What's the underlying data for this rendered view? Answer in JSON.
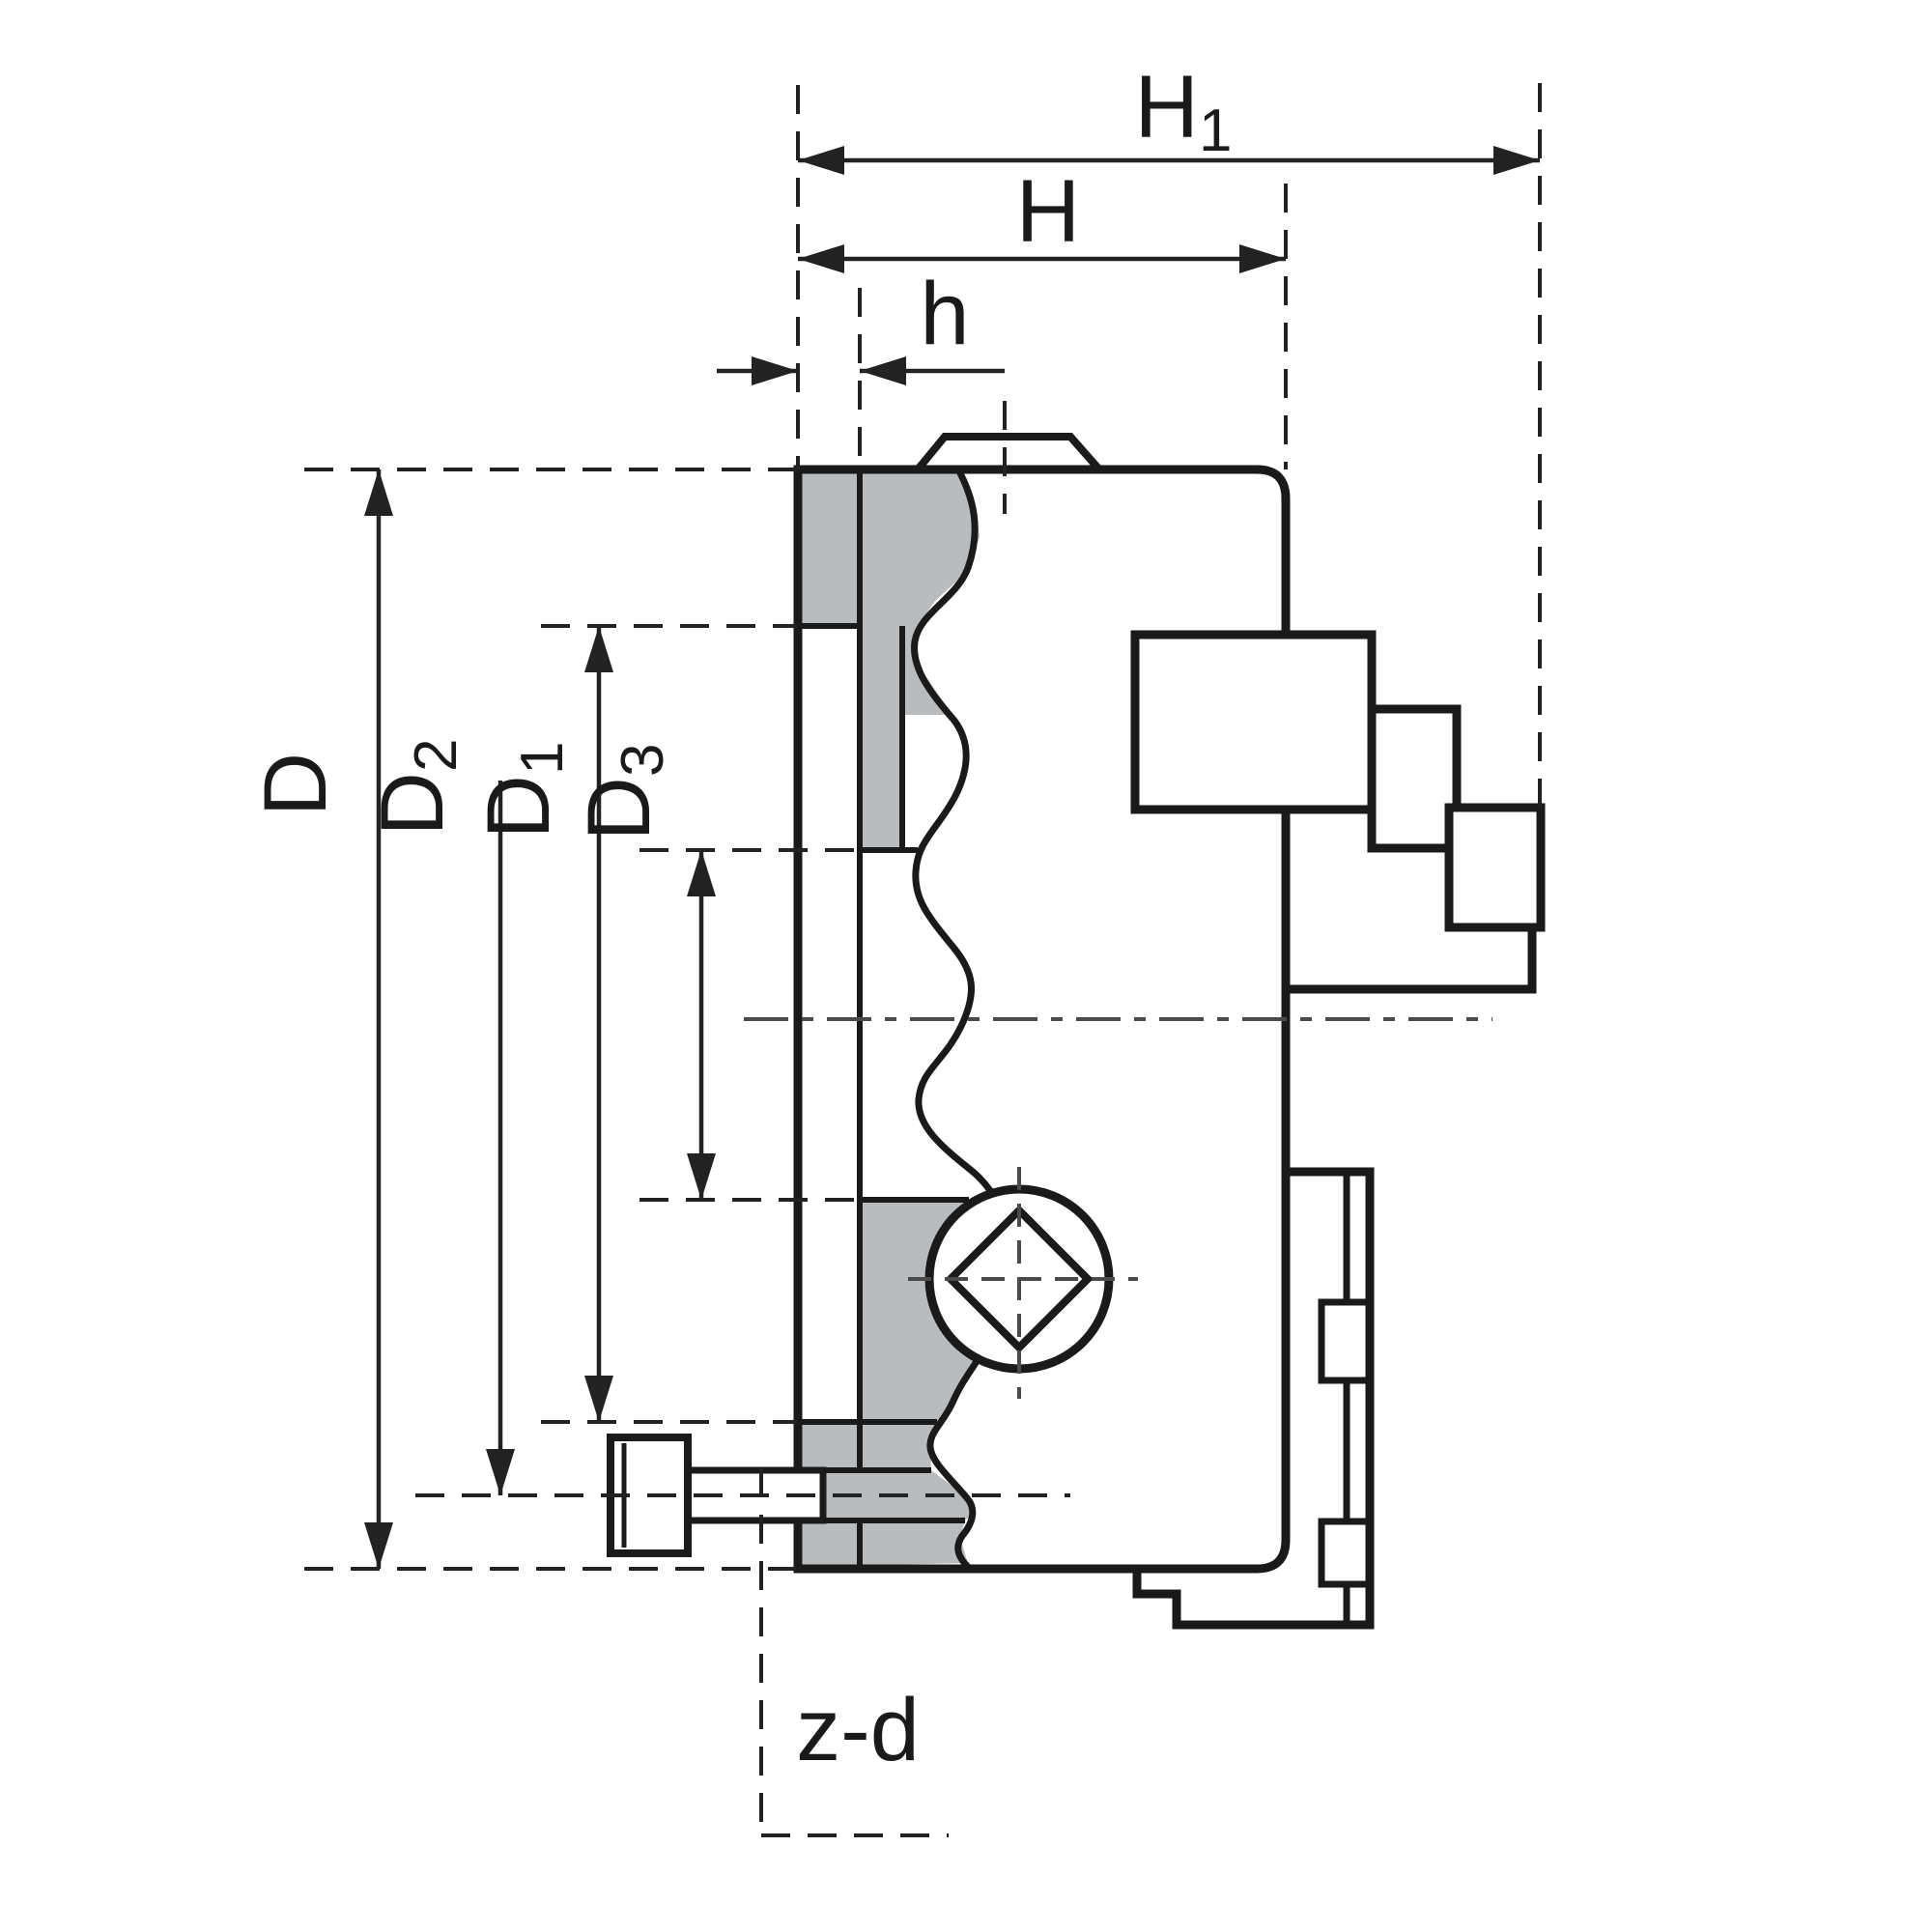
{
  "drawing": {
    "background": "#ffffff",
    "line_color": "#1a1a1a",
    "dim_color": "#222222",
    "section_fill": "#b9bcbe",
    "labels": {
      "H1": {
        "main": "H",
        "sub": "1"
      },
      "H": {
        "main": "H"
      },
      "h": {
        "main": "h"
      },
      "D": {
        "main": "D"
      },
      "D2": {
        "main": "D",
        "sub": "2"
      },
      "D1": {
        "main": "D",
        "sub": "1"
      },
      "D3": {
        "main": "D",
        "sub": "3"
      },
      "zd": {
        "main": "z-d"
      }
    }
  }
}
